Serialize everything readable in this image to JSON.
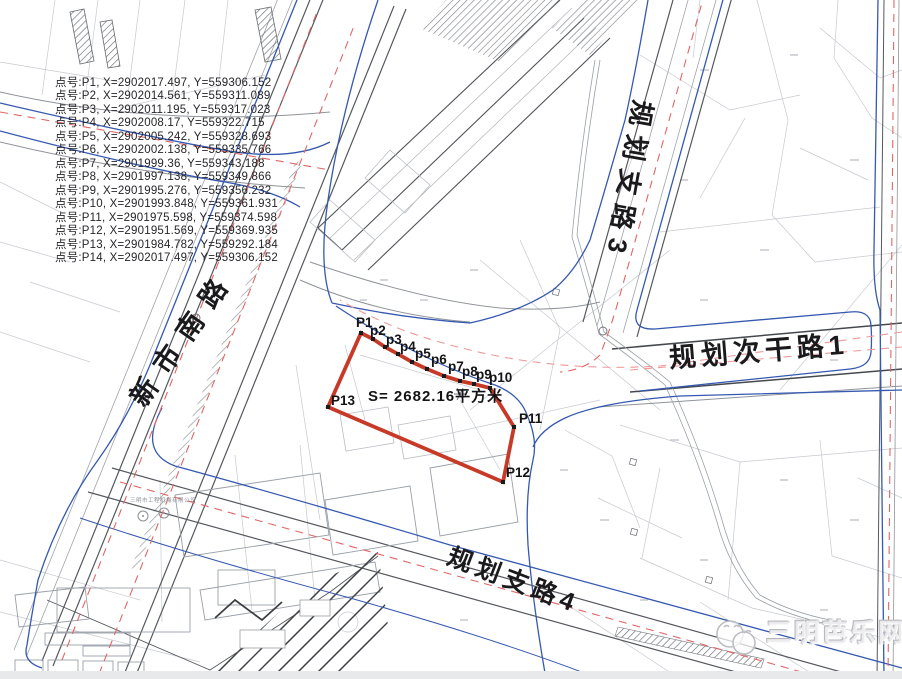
{
  "coordinate_list": {
    "items": [
      "点号:P1, X=2902017.497, Y=559306.152",
      "点号:P2, X=2902014.561, Y=559311.089",
      "点号:P3, X=2902011.195, Y=559317.023",
      "点号:P4, X=2902008.17, Y=559322.715",
      "点号:P5, X=2902005.242, Y=559328.693",
      "点号:P6, X=2902002.138, Y=559335.766",
      "点号:P7, X=2901999.36, Y=559343.188",
      "点号:P8, X=2901997.138, Y=559349.866",
      "点号:P9, X=2901995.276, Y=559356.232",
      "点号:P10, X=2901993.848, Y=559361.931",
      "点号:P11, X=2901975.598, Y=559374.598",
      "点号:P12, X=2901951.569, Y=559369.935",
      "点号:P13, X=2901984.782, Y=559292.184",
      "点号:P14, X=2902017.497, Y=559306.152"
    ]
  },
  "road_labels": {
    "xinshi_nanlu": "新市南路",
    "guihua_zhilu_3": "规划支路3",
    "guihua_ciganlu_1": "规划次干路1",
    "guihua_zhilu_4": "规划支路4"
  },
  "parcel": {
    "area_label": "S= 2682.16平方米",
    "point_labels": [
      "P1",
      "p2",
      "p3",
      "p4",
      "p5",
      "p6",
      "p7",
      "p8",
      "p9",
      "p10",
      "P11",
      "P12",
      "P13"
    ]
  },
  "small_labels": {
    "company": "三明市工程机械有限公司"
  },
  "watermark": {
    "text": "三明芭乐网"
  },
  "colors": {
    "boundary_red": "#c73a28",
    "utility_blue": "#3558b0",
    "planning_dash_red": "#e06666",
    "planning_dash_pink": "#ef9a9a",
    "parcel_gray": "#c6c9cf",
    "road_dark": "#55585e"
  }
}
